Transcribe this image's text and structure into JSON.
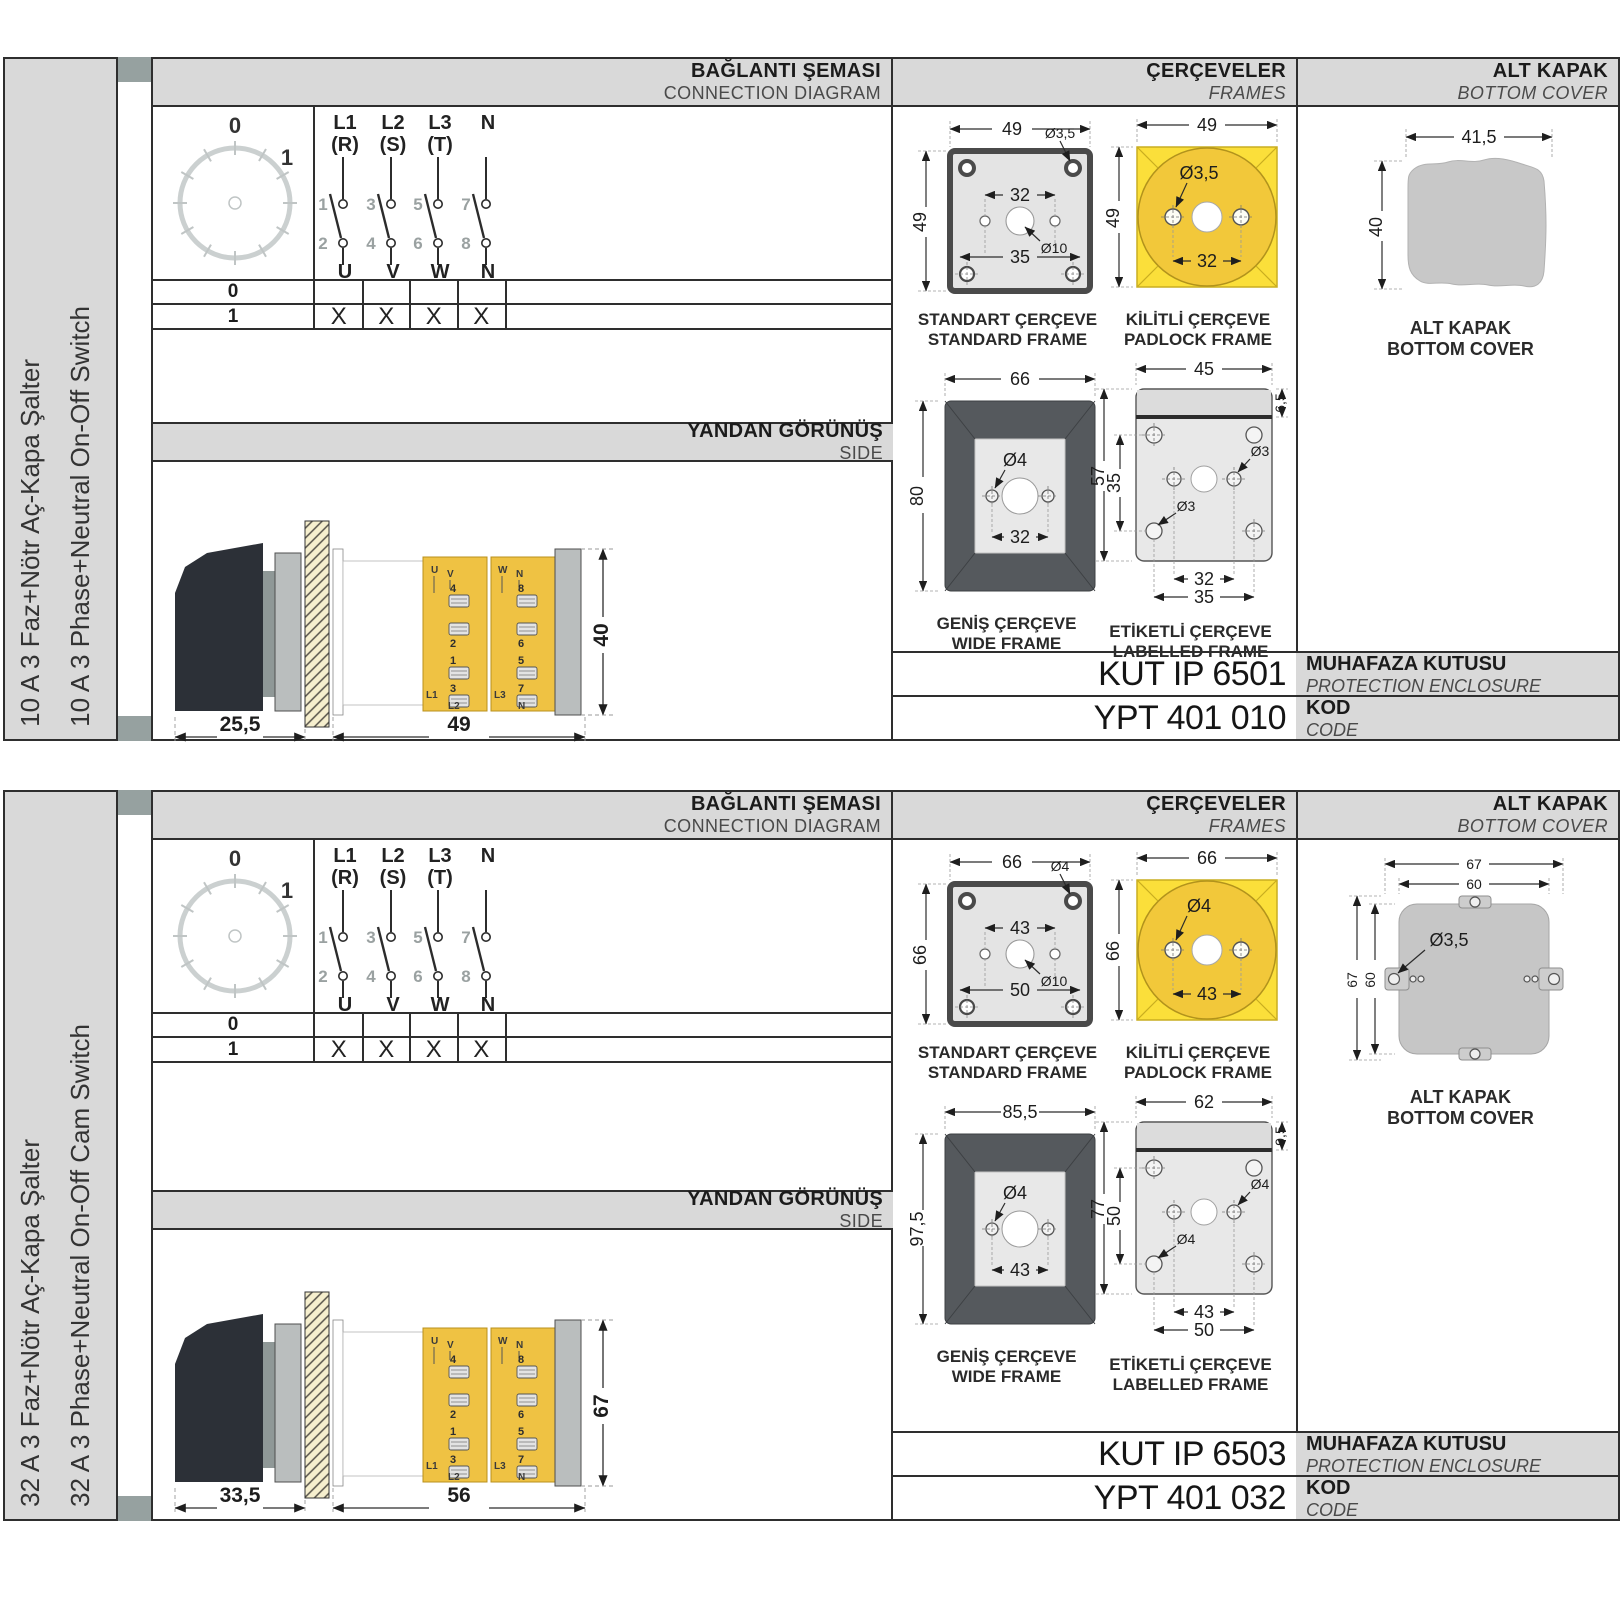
{
  "sections": [
    {
      "side_label_tr": "10 A 3 Faz+Nötr Aç-Kapa Şalter",
      "side_label_en": "10 A 3 Phase+Neutral On-Off Switch",
      "headers": {
        "connection_tr": "BAĞLANTI ŞEMASI",
        "connection_en": "CONNECTION DIAGRAM",
        "frames_tr": "ÇERÇEVELER",
        "frames_en": "FRAMES",
        "cover_tr": "ALT KAPAK",
        "cover_en": "BOTTOM COVER"
      },
      "diagram": {
        "dial": {
          "pos0": "0",
          "pos1": "1"
        },
        "poles": [
          {
            "line1": "L1",
            "line2": "(R)",
            "n_top": "1",
            "n_bot": "2",
            "out": "U"
          },
          {
            "line1": "L2",
            "line2": "(S)",
            "n_top": "3",
            "n_bot": "4",
            "out": "V"
          },
          {
            "line1": "L3",
            "line2": "(T)",
            "n_top": "5",
            "n_bot": "6",
            "out": "W"
          },
          {
            "line1": "N",
            "line2": "",
            "n_top": "7",
            "n_bot": "8",
            "out": "N"
          }
        ],
        "table": {
          "r0label": "0",
          "row0": [
            "",
            "",
            "",
            ""
          ],
          "r1label": "1",
          "row1": [
            "X",
            "X",
            "X",
            "X"
          ]
        }
      },
      "side_view": {
        "band_tr": "YANDAN GÖRÜNÜŞ",
        "band_en": "SIDE",
        "dim_handle": "25,5",
        "dim_body": "49",
        "dim_height": "40",
        "lt": [
          "U",
          "V",
          "4",
          "2",
          "1",
          "3",
          "L1",
          "L2"
        ],
        "rt": [
          "W",
          "N",
          "8",
          "6",
          "5",
          "7",
          "L3",
          "N"
        ]
      },
      "frames": {
        "standard": {
          "cap_tr": "STANDART ÇERÇEVE",
          "cap_en": "STANDARD FRAME",
          "w": "49",
          "h": "49",
          "hole": "Ø3,5",
          "inner": "32",
          "center": "Ø10",
          "bottom": "35"
        },
        "padlock": {
          "cap_tr": "KİLİTLİ ÇERÇEVE",
          "cap_en": "PADLOCK FRAME",
          "w": "49",
          "h": "49",
          "hole": "Ø3,5",
          "inner": "32"
        },
        "wide": {
          "cap_tr": "GENİŞ ÇERÇEVE",
          "cap_en": "WIDE FRAME",
          "w": "66",
          "h": "80",
          "hole": "Ø4",
          "inner": "32"
        },
        "labelled": {
          "cap_tr": "ETİKETLİ ÇERÇEVE",
          "cap_en": "LABELLED FRAME",
          "top": "45",
          "strip": "6,5",
          "h": "57",
          "inner_v": "35",
          "hole1": "Ø3",
          "hole2": "Ø3",
          "inner_h": "32",
          "outer_h": "35"
        }
      },
      "cover": {
        "cap_tr": "ALT KAPAK",
        "cap_en": "BOTTOM COVER",
        "w": "41,5",
        "h": "40"
      },
      "codes": {
        "enclosure": "KUT IP 6501",
        "enclosure_tr": "MUHAFAZA KUTUSU",
        "enclosure_en": "PROTECTION ENCLOSURE",
        "code": "YPT 401 010",
        "code_tr": "KOD",
        "code_en": "CODE"
      }
    },
    {
      "side_label_tr": "32 A 3 Faz+Nötr Aç-Kapa Şalter",
      "side_label_en": "32 A 3 Phase+Neutral On-Off Cam Switch",
      "headers": {
        "connection_tr": "BAĞLANTI ŞEMASI",
        "connection_en": "CONNECTION DIAGRAM",
        "frames_tr": "ÇERÇEVELER",
        "frames_en": "FRAMES",
        "cover_tr": "ALT KAPAK",
        "cover_en": "BOTTOM COVER"
      },
      "diagram": {
        "dial": {
          "pos0": "0",
          "pos1": "1"
        },
        "poles": [
          {
            "line1": "L1",
            "line2": "(R)",
            "n_top": "1",
            "n_bot": "2",
            "out": "U"
          },
          {
            "line1": "L2",
            "line2": "(S)",
            "n_top": "3",
            "n_bot": "4",
            "out": "V"
          },
          {
            "line1": "L3",
            "line2": "(T)",
            "n_top": "5",
            "n_bot": "6",
            "out": "W"
          },
          {
            "line1": "N",
            "line2": "",
            "n_top": "7",
            "n_bot": "8",
            "out": "N"
          }
        ],
        "table": {
          "r0label": "0",
          "row0": [
            "",
            "",
            "",
            ""
          ],
          "r1label": "1",
          "row1": [
            "X",
            "X",
            "X",
            "X"
          ]
        }
      },
      "side_view": {
        "band_tr": "YANDAN GÖRÜNÜŞ",
        "band_en": "SIDE",
        "dim_handle": "33,5",
        "dim_body": "56",
        "dim_height": "67",
        "lt": [
          "U",
          "V",
          "4",
          "2",
          "1",
          "3",
          "L1",
          "L2"
        ],
        "rt": [
          "W",
          "N",
          "8",
          "6",
          "5",
          "7",
          "L3",
          "N"
        ]
      },
      "frames": {
        "standard": {
          "cap_tr": "STANDART ÇERÇEVE",
          "cap_en": "STANDARD FRAME",
          "w": "66",
          "h": "66",
          "hole": "Ø4",
          "inner": "43",
          "center": "Ø10",
          "bottom": "50"
        },
        "padlock": {
          "cap_tr": "KİLİTLİ ÇERÇEVE",
          "cap_en": "PADLOCK FRAME",
          "w": "66",
          "h": "66",
          "hole": "Ø4",
          "inner": "43"
        },
        "wide": {
          "cap_tr": "GENİŞ ÇERÇEVE",
          "cap_en": "WIDE FRAME",
          "w": "85,5",
          "h": "97,5",
          "hole": "Ø4",
          "inner": "43"
        },
        "labelled": {
          "cap_tr": "ETİKETLİ ÇERÇEVE",
          "cap_en": "LABELLED FRAME",
          "top": "62",
          "strip": "9,5",
          "h": "77",
          "inner_v": "50",
          "hole1": "Ø4",
          "hole2": "Ø4",
          "inner_h": "43",
          "outer_h": "50"
        }
      },
      "cover": {
        "cap_tr": "ALT KAPAK",
        "cap_en": "BOTTOM COVER",
        "w1": "67",
        "w2": "60",
        "h1": "67",
        "h2": "60",
        "hole": "Ø3,5"
      },
      "codes": {
        "enclosure": "KUT IP 6503",
        "enclosure_tr": "MUHAFAZA KUTUSU",
        "enclosure_en": "PROTECTION ENCLOSURE",
        "code": "YPT 401 032",
        "code_tr": "KOD",
        "code_en": "CODE"
      }
    }
  ]
}
